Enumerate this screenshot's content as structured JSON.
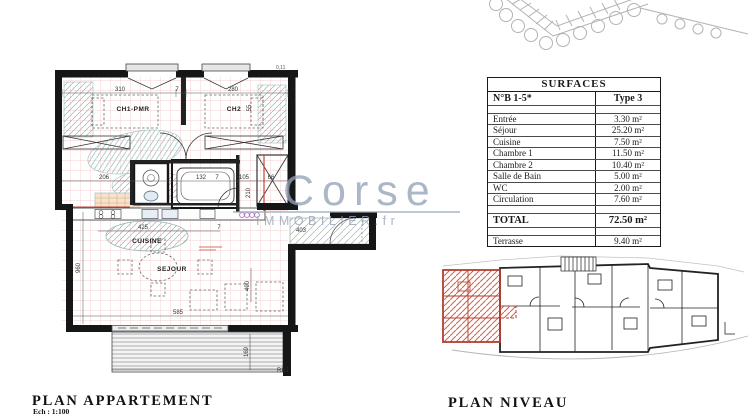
{
  "watermark": {
    "brand": "Corse",
    "suffix": "IMMOBILIER.fr"
  },
  "surfaces_table": {
    "title": "SURFACES",
    "unit_label": "N°B 1-5*",
    "type_label": "Type 3",
    "rows": [
      {
        "label": "Entrée",
        "value": "3.30 m²"
      },
      {
        "label": "Séjour",
        "value": "25.20 m²"
      },
      {
        "label": "Cuisine",
        "value": "7.50 m²"
      },
      {
        "label": "Chambre 1",
        "value": "11.50 m²"
      },
      {
        "label": "Chambre 2",
        "value": "10.40 m²"
      },
      {
        "label": "Salle de Bain",
        "value": "5.00 m²"
      },
      {
        "label": "WC",
        "value": "2.00 m²"
      },
      {
        "label": "Circulation",
        "value": "7.60 m²"
      }
    ],
    "total_label": "TOTAL",
    "total_value": "72.50 m²",
    "terrace_label": "Terrasse",
    "terrace_value": "9.40 m²"
  },
  "apartment_plan": {
    "rooms": [
      {
        "t": "CH1-PMR"
      },
      {
        "t": "CH2"
      },
      {
        "t": "CUISINE"
      },
      {
        "t": "SEJOUR"
      }
    ],
    "dims": [
      {
        "t": "310"
      },
      {
        "t": "7"
      },
      {
        "t": "280"
      },
      {
        "t": "55"
      },
      {
        "t": "206"
      },
      {
        "t": "132"
      },
      {
        "t": "7"
      },
      {
        "t": "105"
      },
      {
        "t": "66"
      },
      {
        "t": "210"
      },
      {
        "t": "403"
      },
      {
        "t": "425"
      },
      {
        "t": "7"
      },
      {
        "t": "960"
      },
      {
        "t": "400"
      },
      {
        "t": "585"
      },
      {
        "t": "169"
      }
    ],
    "corner_label": "RDJ",
    "level_mark": "0,11"
  },
  "footer": {
    "plan_appartement": "PLAN APPARTEMENT",
    "scale": "Ech : 1:100",
    "plan_niveau": "PLAN NIVEAU"
  },
  "colors": {
    "wall": "#161616",
    "grid_pink": "#eec3c3",
    "accent_red": "#cc4433",
    "hatch_teal": "#8fb8b8",
    "niveau_highlight": "#c8503c",
    "watermark": "#93a3b7"
  }
}
